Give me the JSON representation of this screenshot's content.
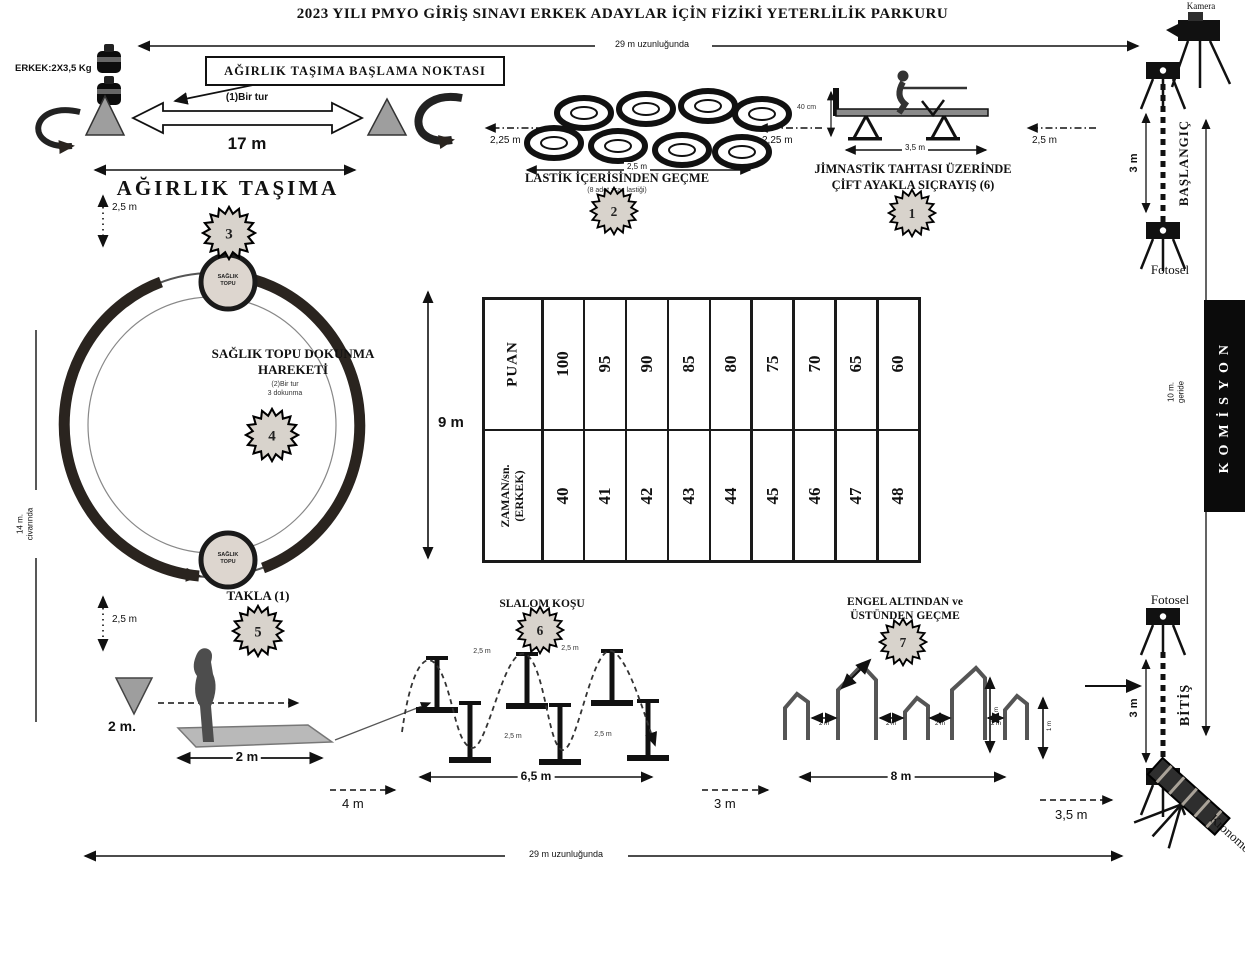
{
  "title": "2023 YILI PMYO GİRİŞ SINAVI ERKEK ADAYLAR İÇİN FİZİKİ YETERLİLİK PARKURU",
  "course": {
    "top_length_label": "29 m uzunluğunda",
    "bottom_length_label": "29 m uzunluğunda"
  },
  "start": {
    "camera_label": "Kamera",
    "label": "BAŞLANGIÇ",
    "gate_width": "3 m",
    "photocell_label": "Fotosel",
    "gap_to_course": "2,5 m"
  },
  "finish": {
    "label": "BİTİŞ",
    "gate_width": "3 m",
    "photocell_label": "Fotosel",
    "stopwatch_label": "Kronometre",
    "gap_before": "3,5 m"
  },
  "commission": {
    "label": "KOMİSYON",
    "note_line1": "10 m.",
    "note_line2": "geride"
  },
  "stations": {
    "weight_carry": {
      "badge": "3",
      "name": "AĞIRLIK TAŞIMA",
      "start_box_label": "AĞIRLIK TAŞIMA BAŞLAMA NOKTASI",
      "weight_label": "ERKEK:2X3,5 Kg",
      "lap_label": "(1)Bir tur",
      "length": "17 m",
      "gap_down": "2,5 m"
    },
    "tires": {
      "badge": "2",
      "name": "LASTİK İÇERİSİNDEN GEÇME",
      "note": "(8 adet araç lastiği)",
      "length": "2,5 m",
      "gap_left": "2,25 m",
      "gap_right": "2,25 m"
    },
    "gym_board": {
      "badge": "1",
      "name_line1": "JİMNASTİK TAHTASI ÜZERİNDE",
      "name_line2": "ÇİFT AYAKLA SIÇRAYIŞ (6)",
      "height_label": "40 cm",
      "length": "3,5 m"
    },
    "medicine_ball": {
      "badge": "4",
      "name_line1": "SAĞLIK TOPU DOKUNMA",
      "name_line2": "HAREKETİ",
      "note_line1": "(2)Bir tur",
      "note_line2": "3 dokunma",
      "diameter": "9 m",
      "ball_top_line1": "SAĞLIK",
      "ball_top_line2": "TOPU",
      "ball_bottom_line1": "SAĞLIK",
      "ball_bottom_line2": "TOPU",
      "side_label_line1": "14 m.",
      "side_label_line2": "civarında",
      "gap_down": "2,5 m"
    },
    "somersault": {
      "badge": "5",
      "name": "TAKLA (1)",
      "cone_gap": "2 m.",
      "mat_length": "2 m"
    },
    "slalom": {
      "badge": "6",
      "name": "SLALOM KOŞU",
      "gap_labels": [
        "2,5 m",
        "2,5 m",
        "2,5 m",
        "2,5 m"
      ],
      "length": "6,5 m",
      "gap_left": "4 m",
      "gap_right": "3 m"
    },
    "obstacles": {
      "badge": "7",
      "name_line1": "ENGEL ALTINDAN ve",
      "name_line2": "ÜSTÜNDEN GEÇME",
      "gaps": [
        "2 m",
        "2 m",
        "2 m",
        "2 m"
      ],
      "heights": [
        "1 m",
        "1 m"
      ],
      "length": "8 m"
    }
  },
  "score_table": {
    "row1_header": "PUAN",
    "row1_values": [
      "100",
      "95",
      "90",
      "85",
      "80",
      "75",
      "70",
      "65",
      "60"
    ],
    "row2_header_line1": "ZAMAN/sn.",
    "row2_header_line2": "(ERKEK)",
    "row2_values": [
      "40",
      "41",
      "42",
      "43",
      "44",
      "45",
      "46",
      "47",
      "48"
    ]
  }
}
